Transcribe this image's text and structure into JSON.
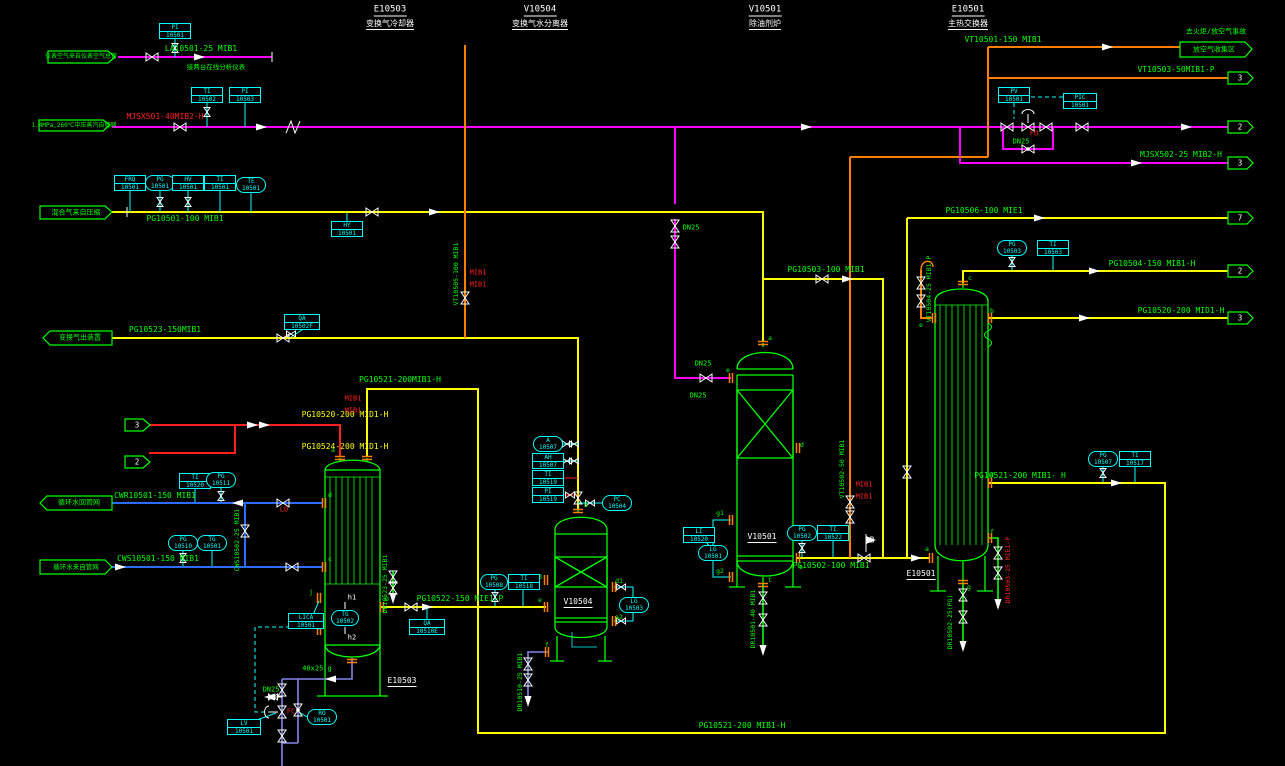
{
  "colors": {
    "green": "#00ff00",
    "yellow": "#ffff00",
    "magenta": "#ff00ff",
    "red": "#ff2020",
    "cyan": "#00ffff",
    "orange": "#ff7f00",
    "blue": "#2e6bff",
    "purple": "#8585ea",
    "white": "#ffffff"
  },
  "labels": [
    {
      "t": "E10503",
      "x": 390,
      "y": 11,
      "c": "white",
      "u": 1,
      "fs": 9,
      "n": "header-e10503"
    },
    {
      "t": "变换气冷却器",
      "x": 390,
      "y": 25,
      "c": "white",
      "u": 1,
      "fs": 8,
      "n": "header-e10503-sub"
    },
    {
      "t": "V10504",
      "x": 540,
      "y": 11,
      "c": "white",
      "u": 1,
      "fs": 9,
      "n": "header-v10504"
    },
    {
      "t": "变换气水分离器",
      "x": 540,
      "y": 25,
      "c": "white",
      "u": 1,
      "fs": 8,
      "n": "header-v10504-sub"
    },
    {
      "t": "V10501",
      "x": 765,
      "y": 11,
      "c": "white",
      "u": 1,
      "fs": 9,
      "n": "header-v10501"
    },
    {
      "t": "除油剂炉",
      "x": 765,
      "y": 25,
      "c": "white",
      "u": 1,
      "fs": 8,
      "n": "header-v10501-sub"
    },
    {
      "t": "E10501",
      "x": 968,
      "y": 11,
      "c": "white",
      "u": 1,
      "fs": 9,
      "n": "header-e10501"
    },
    {
      "t": "主热交换器",
      "x": 968,
      "y": 25,
      "c": "white",
      "u": 1,
      "fs": 8,
      "n": "header-e10501-sub"
    },
    {
      "t": "E10503",
      "x": 402,
      "y": 682,
      "c": "white",
      "u": 1,
      "fs": 8,
      "n": "equip-label-e10503"
    },
    {
      "t": "V10504",
      "x": 578,
      "y": 603,
      "c": "white",
      "u": 1,
      "fs": 8,
      "n": "equip-label-v10504"
    },
    {
      "t": "V10501",
      "x": 762,
      "y": 538,
      "c": "white",
      "u": 1,
      "fs": 8,
      "n": "equip-label-v10501"
    },
    {
      "t": "E10501",
      "x": 921,
      "y": 575,
      "c": "white",
      "u": 1,
      "fs": 8,
      "n": "equip-label-e10501"
    },
    {
      "t": "仪表空气来自仪表空气总管",
      "x": 81,
      "y": 57,
      "fs": 6,
      "n": "flag-instrument-air"
    },
    {
      "t": "1.4MPa,260℃中压蒸汽自管网",
      "x": 74,
      "y": 126,
      "fs": 6,
      "n": "flag-mp-steam"
    },
    {
      "t": "混合气来自压缩",
      "x": 76,
      "y": 213,
      "fs": 7,
      "n": "flag-mixed-gas"
    },
    {
      "t": "变换气出装置",
      "x": 80,
      "y": 338,
      "fs": 7,
      "n": "flag-shift-gas-out"
    },
    {
      "t": "循环水回管网",
      "x": 79,
      "y": 503,
      "fs": 7,
      "n": "flag-cw-return"
    },
    {
      "t": "循环水来自管网",
      "x": 76,
      "y": 567,
      "fs": 6.5,
      "n": "flag-cw-supply"
    },
    {
      "t": "去火炬/放空气事故",
      "x": 1216,
      "y": 32,
      "fs": 7,
      "n": "note-flare"
    },
    {
      "t": "放空气收集区",
      "x": 1214,
      "y": 50,
      "fs": 7,
      "n": "flag-vent-header"
    },
    {
      "t": "3",
      "x": 137,
      "y": 425,
      "c": "white",
      "fs": 7.5,
      "n": "offpage-3-left"
    },
    {
      "t": "2",
      "x": 137,
      "y": 462,
      "c": "white",
      "fs": 7.5,
      "n": "offpage-2-left"
    },
    {
      "t": "3",
      "x": 1240,
      "y": 78,
      "c": "white",
      "fs": 7.5,
      "n": "offpage-3a"
    },
    {
      "t": "2",
      "x": 1240,
      "y": 127,
      "c": "white",
      "fs": 7.5,
      "n": "offpage-2a"
    },
    {
      "t": "3",
      "x": 1240,
      "y": 163,
      "c": "white",
      "fs": 7.5,
      "n": "offpage-3b"
    },
    {
      "t": "7",
      "x": 1240,
      "y": 218,
      "c": "white",
      "fs": 7.5,
      "n": "offpage-7"
    },
    {
      "t": "2",
      "x": 1240,
      "y": 271,
      "c": "white",
      "fs": 7.5,
      "n": "offpage-2b"
    },
    {
      "t": "3",
      "x": 1240,
      "y": 318,
      "c": "white",
      "fs": 7.5,
      "n": "offpage-3c"
    },
    {
      "t": "LA10501-25 MIB1",
      "x": 201,
      "y": 49,
      "n": "line-label"
    },
    {
      "t": "接两台在线分析仪表",
      "x": 216,
      "y": 67,
      "fs": 6.5,
      "n": "line-note"
    },
    {
      "t": "MJSX501-40MIB2-H",
      "x": 165,
      "y": 117,
      "c": "red",
      "n": "line-label"
    },
    {
      "t": "PG10501-100 MIB1",
      "x": 185,
      "y": 219,
      "n": "line-label"
    },
    {
      "t": "PG10523-150MIB1",
      "x": 165,
      "y": 330,
      "n": "line-label"
    },
    {
      "t": "PG10520-200 MID1-H",
      "x": 345,
      "y": 415,
      "c": "yellow",
      "n": "line-label"
    },
    {
      "t": "PG10524-200 MID1-H",
      "x": 345,
      "y": 447,
      "c": "yellow",
      "n": "line-label"
    },
    {
      "t": "PG10521-200MIB1-H",
      "x": 400,
      "y": 380,
      "n": "line-label"
    },
    {
      "t": "CWR10501-150 MIB1",
      "x": 155,
      "y": 496,
      "n": "line-label"
    },
    {
      "t": "CWS10501-150 MIB1",
      "x": 158,
      "y": 559,
      "n": "line-label"
    },
    {
      "t": "PG10522-150 MIE1-P",
      "x": 460,
      "y": 599,
      "n": "line-label"
    },
    {
      "t": "PG10502-100 MIB1",
      "x": 831,
      "y": 566,
      "n": "line-label"
    },
    {
      "t": "PG10503-100 MIB1",
      "x": 826,
      "y": 270,
      "n": "line-label"
    },
    {
      "t": "VT10501-150 MIB1",
      "x": 1003,
      "y": 40,
      "n": "line-label"
    },
    {
      "t": "VT10503-50MIB1-P",
      "x": 1176,
      "y": 70,
      "n": "line-label"
    },
    {
      "t": "MJSX502-25 MIB2-H",
      "x": 1181,
      "y": 155,
      "n": "line-label"
    },
    {
      "t": "PG10506-100 MIE1",
      "x": 984,
      "y": 211,
      "n": "line-label"
    },
    {
      "t": "PG10504-150 MIB1-H",
      "x": 1152,
      "y": 264,
      "n": "line-label"
    },
    {
      "t": "PG10520-200 MID1-H",
      "x": 1181,
      "y": 311,
      "n": "line-label"
    },
    {
      "t": "PG10521-200 MIB1- H",
      "x": 1020,
      "y": 476,
      "n": "line-label"
    },
    {
      "t": "PG10521-200 MIB1-H",
      "x": 742,
      "y": 726,
      "n": "line-label"
    },
    {
      "t": "DN25",
      "x": 691,
      "y": 228,
      "fs": 7,
      "n": "size-label"
    },
    {
      "t": "DN25",
      "x": 703,
      "y": 364,
      "fs": 7,
      "n": "size-label"
    },
    {
      "t": "DN25",
      "x": 698,
      "y": 396,
      "fs": 7,
      "n": "size-label"
    },
    {
      "t": "DN25",
      "x": 1021,
      "y": 142,
      "fs": 7,
      "n": "size-label"
    },
    {
      "t": "DN25",
      "x": 271,
      "y": 690,
      "fs": 7,
      "n": "size-label"
    },
    {
      "t": "40x25 g",
      "x": 317,
      "y": 669,
      "fs": 7,
      "n": "size-label"
    },
    {
      "t": "VT10505-100 MIB1",
      "x": 456,
      "y": 274,
      "rot": 1,
      "fs": 6.5,
      "n": "line-label"
    },
    {
      "t": "VT10502-50 MIB1",
      "x": 842,
      "y": 469,
      "rot": 1,
      "fs": 6.5,
      "n": "line-label"
    },
    {
      "t": "VT10504-25 MIB1-P",
      "x": 929,
      "y": 289,
      "rot": 1,
      "fs": 6.5,
      "n": "line-label"
    },
    {
      "t": "DR10501-40 MIB1",
      "x": 753,
      "y": 619,
      "rot": 1,
      "fs": 6.5,
      "n": "line-label"
    },
    {
      "t": "DR10502-25(PG)",
      "x": 950,
      "y": 622,
      "rot": 1,
      "fs": 6.5,
      "n": "line-label"
    },
    {
      "t": "DR10503-25 MIE1-P",
      "x": 1008,
      "y": 570,
      "rot": 1,
      "c": "red",
      "fs": 6.5,
      "n": "line-label"
    },
    {
      "t": "DR10510-25 MIB1",
      "x": 520,
      "y": 682,
      "rot": 1,
      "fs": 6.5,
      "n": "line-label"
    },
    {
      "t": "DR10523-25 MIB1",
      "x": 385,
      "y": 584,
      "rot": 1,
      "fs": 6.5,
      "n": "line-label"
    },
    {
      "t": "CWS10502-25 MIB1",
      "x": 237,
      "y": 540,
      "rot": 1,
      "fs": 6.5,
      "n": "line-label"
    },
    {
      "t": "MIB1",
      "x": 353,
      "y": 399,
      "c": "red",
      "fs": 7,
      "n": "spec-break"
    },
    {
      "t": "MIB1",
      "x": 353,
      "y": 411,
      "c": "red",
      "fs": 7,
      "n": "spec-break"
    },
    {
      "t": "MIB1",
      "x": 478,
      "y": 273,
      "c": "red",
      "fs": 7,
      "n": "spec-break"
    },
    {
      "t": "MIB1",
      "x": 478,
      "y": 285,
      "c": "red",
      "fs": 7,
      "n": "spec-break"
    },
    {
      "t": "MIB1",
      "x": 864,
      "y": 485,
      "c": "red",
      "fs": 7,
      "n": "spec-break"
    },
    {
      "t": "MIB1",
      "x": 864,
      "y": 497,
      "c": "red",
      "fs": 7,
      "n": "spec-break"
    },
    {
      "t": "FO",
      "x": 1034,
      "y": 134,
      "c": "red",
      "fs": 7,
      "n": "valve-action"
    },
    {
      "t": "FC",
      "x": 291,
      "y": 712,
      "c": "red",
      "fs": 7,
      "n": "valve-action"
    },
    {
      "t": "LO",
      "x": 284,
      "y": 510,
      "c": "red",
      "fs": 7,
      "n": "valve-action"
    },
    {
      "t": "h1",
      "x": 352,
      "y": 598,
      "c": "white",
      "fs": 7,
      "n": "tap-label"
    },
    {
      "t": "h2",
      "x": 352,
      "y": 638,
      "c": "white",
      "fs": 7,
      "n": "tap-label"
    },
    {
      "t": "B",
      "x": 872,
      "y": 540,
      "c": "white",
      "fs": 7.5,
      "n": "tie-point-b"
    },
    {
      "t": "a",
      "x": 333,
      "y": 450,
      "fs": 6.5,
      "n": "nozzle"
    },
    {
      "t": "D",
      "x": 387,
      "y": 599,
      "fs": 6.5,
      "n": "nozzle"
    },
    {
      "t": "j",
      "x": 311,
      "y": 592,
      "fs": 6.5,
      "n": "nozzle"
    },
    {
      "t": "i",
      "x": 311,
      "y": 625,
      "fs": 6.5,
      "n": "nozzle"
    },
    {
      "t": "d",
      "x": 330,
      "y": 495,
      "fs": 6.5,
      "n": "nozzle"
    },
    {
      "t": "c",
      "x": 330,
      "y": 559,
      "fs": 6.5,
      "n": "nozzle"
    },
    {
      "t": "b",
      "x": 586,
      "y": 505,
      "fs": 6.5,
      "n": "nozzle"
    },
    {
      "t": "d",
      "x": 540,
      "y": 577,
      "fs": 6.5,
      "n": "nozzle"
    },
    {
      "t": "e",
      "x": 540,
      "y": 600,
      "fs": 6.5,
      "n": "nozzle"
    },
    {
      "t": "d1",
      "x": 619,
      "y": 581,
      "fs": 6.5,
      "n": "nozzle"
    },
    {
      "t": "a2",
      "x": 619,
      "y": 617,
      "fs": 6.5,
      "n": "nozzle"
    },
    {
      "t": "f",
      "x": 547,
      "y": 645,
      "fs": 6.5,
      "n": "nozzle"
    },
    {
      "t": "a",
      "x": 770,
      "y": 338,
      "fs": 6.5,
      "n": "nozzle"
    },
    {
      "t": "e",
      "x": 728,
      "y": 370,
      "fs": 6.5,
      "n": "nozzle"
    },
    {
      "t": "d",
      "x": 802,
      "y": 445,
      "fs": 6.5,
      "n": "nozzle"
    },
    {
      "t": "g1",
      "x": 720,
      "y": 513,
      "fs": 6.5,
      "n": "nozzle"
    },
    {
      "t": "g2",
      "x": 720,
      "y": 571,
      "fs": 6.5,
      "n": "nozzle"
    },
    {
      "t": "b",
      "x": 801,
      "y": 567,
      "fs": 6.5,
      "n": "nozzle"
    },
    {
      "t": "t",
      "x": 770,
      "y": 580,
      "fs": 6.5,
      "n": "nozzle"
    },
    {
      "t": "c",
      "x": 970,
      "y": 278,
      "fs": 6.5,
      "n": "nozzle"
    },
    {
      "t": "e",
      "x": 921,
      "y": 325,
      "fs": 6.5,
      "n": "nozzle"
    },
    {
      "t": "b",
      "x": 992,
      "y": 311,
      "fs": 6.5,
      "n": "nozzle"
    },
    {
      "t": "a",
      "x": 927,
      "y": 549,
      "fs": 6.5,
      "n": "nozzle"
    },
    {
      "t": "d",
      "x": 992,
      "y": 475,
      "fs": 6.5,
      "n": "nozzle"
    },
    {
      "t": "f",
      "x": 992,
      "y": 532,
      "fs": 6.5,
      "n": "nozzle"
    },
    {
      "t": "g",
      "x": 969,
      "y": 587,
      "fs": 6.5,
      "n": "nozzle"
    }
  ],
  "instruments": [
    {
      "tag": "PI",
      "num": "10501",
      "sh": "b",
      "x": 175,
      "y": 31
    },
    {
      "tag": "TI",
      "num": "10502",
      "sh": "b",
      "x": 207,
      "y": 95
    },
    {
      "tag": "PI",
      "num": "10503",
      "sh": "b",
      "x": 245,
      "y": 95
    },
    {
      "tag": "FRQ",
      "num": "10501",
      "sh": "b",
      "x": 130,
      "y": 183
    },
    {
      "tag": "PG",
      "num": "10501",
      "sh": "o",
      "x": 160,
      "y": 183
    },
    {
      "tag": "HV",
      "num": "10501",
      "sh": "b",
      "x": 188,
      "y": 183
    },
    {
      "tag": "TI",
      "num": "10501",
      "sh": "b",
      "x": 220,
      "y": 183
    },
    {
      "tag": "TE",
      "num": "10501",
      "sh": "o",
      "x": 251,
      "y": 185
    },
    {
      "tag": "HY",
      "num": "10501",
      "sh": "b",
      "x": 347,
      "y": 229
    },
    {
      "tag": "QA",
      "num": "10502F",
      "sh": "b",
      "x": 302,
      "y": 322,
      "w": 36
    },
    {
      "tag": "A",
      "num": "10507",
      "sh": "o",
      "x": 548,
      "y": 444
    },
    {
      "tag": "AH",
      "num": "10507",
      "sh": "b",
      "x": 548,
      "y": 461
    },
    {
      "tag": "TI",
      "num": "10519",
      "sh": "b",
      "x": 548,
      "y": 478
    },
    {
      "tag": "PI",
      "num": "10519",
      "sh": "b",
      "x": 548,
      "y": 495
    },
    {
      "tag": "PC",
      "num": "10504",
      "sh": "o",
      "x": 617,
      "y": 503
    },
    {
      "tag": "PG",
      "num": "10508",
      "sh": "o",
      "x": 494,
      "y": 582,
      "w": 28
    },
    {
      "tag": "TI",
      "num": "10518",
      "sh": "b",
      "x": 524,
      "y": 582
    },
    {
      "tag": "LG",
      "num": "10503",
      "sh": "o",
      "x": 634,
      "y": 605
    },
    {
      "tag": "LICA",
      "num": "10501",
      "sh": "b",
      "x": 306,
      "y": 621,
      "w": 36
    },
    {
      "tag": "QA",
      "num": "10510E",
      "sh": "b",
      "x": 427,
      "y": 627,
      "w": 36
    },
    {
      "tag": "TG",
      "num": "10502",
      "sh": "o",
      "x": 345,
      "y": 618,
      "w": 28
    },
    {
      "tag": "LV",
      "num": "10501",
      "sh": "b",
      "x": 244,
      "y": 727,
      "w": 34
    },
    {
      "tag": "RO",
      "num": "10501",
      "sh": "o",
      "x": 322,
      "y": 717
    },
    {
      "tag": "PG",
      "num": "10502",
      "sh": "o",
      "x": 802,
      "y": 533
    },
    {
      "tag": "TI",
      "num": "10522",
      "sh": "b",
      "x": 833,
      "y": 533
    },
    {
      "tag": "LI",
      "num": "10520",
      "sh": "b",
      "x": 699,
      "y": 535
    },
    {
      "tag": "LG",
      "num": "10501",
      "sh": "o",
      "x": 713,
      "y": 553
    },
    {
      "tag": "PV",
      "num": "10501",
      "sh": "b",
      "x": 1014,
      "y": 95
    },
    {
      "tag": "PIC",
      "num": "10501",
      "sh": "b",
      "x": 1080,
      "y": 101,
      "w": 34
    },
    {
      "tag": "PG",
      "num": "10503",
      "sh": "o",
      "x": 1012,
      "y": 248
    },
    {
      "tag": "TI",
      "num": "10503",
      "sh": "b",
      "x": 1053,
      "y": 248
    },
    {
      "tag": "PG",
      "num": "10507",
      "sh": "o",
      "x": 1103,
      "y": 459
    },
    {
      "tag": "TI",
      "num": "10517",
      "sh": "b",
      "x": 1135,
      "y": 459
    },
    {
      "tag": "TI",
      "num": "10520",
      "sh": "b",
      "x": 195,
      "y": 481
    },
    {
      "tag": "PG",
      "num": "10511",
      "sh": "o",
      "x": 221,
      "y": 480
    },
    {
      "tag": "PG",
      "num": "10510",
      "sh": "o",
      "x": 183,
      "y": 543
    },
    {
      "tag": "TG",
      "num": "10501",
      "sh": "o",
      "x": 212,
      "y": 543
    }
  ]
}
